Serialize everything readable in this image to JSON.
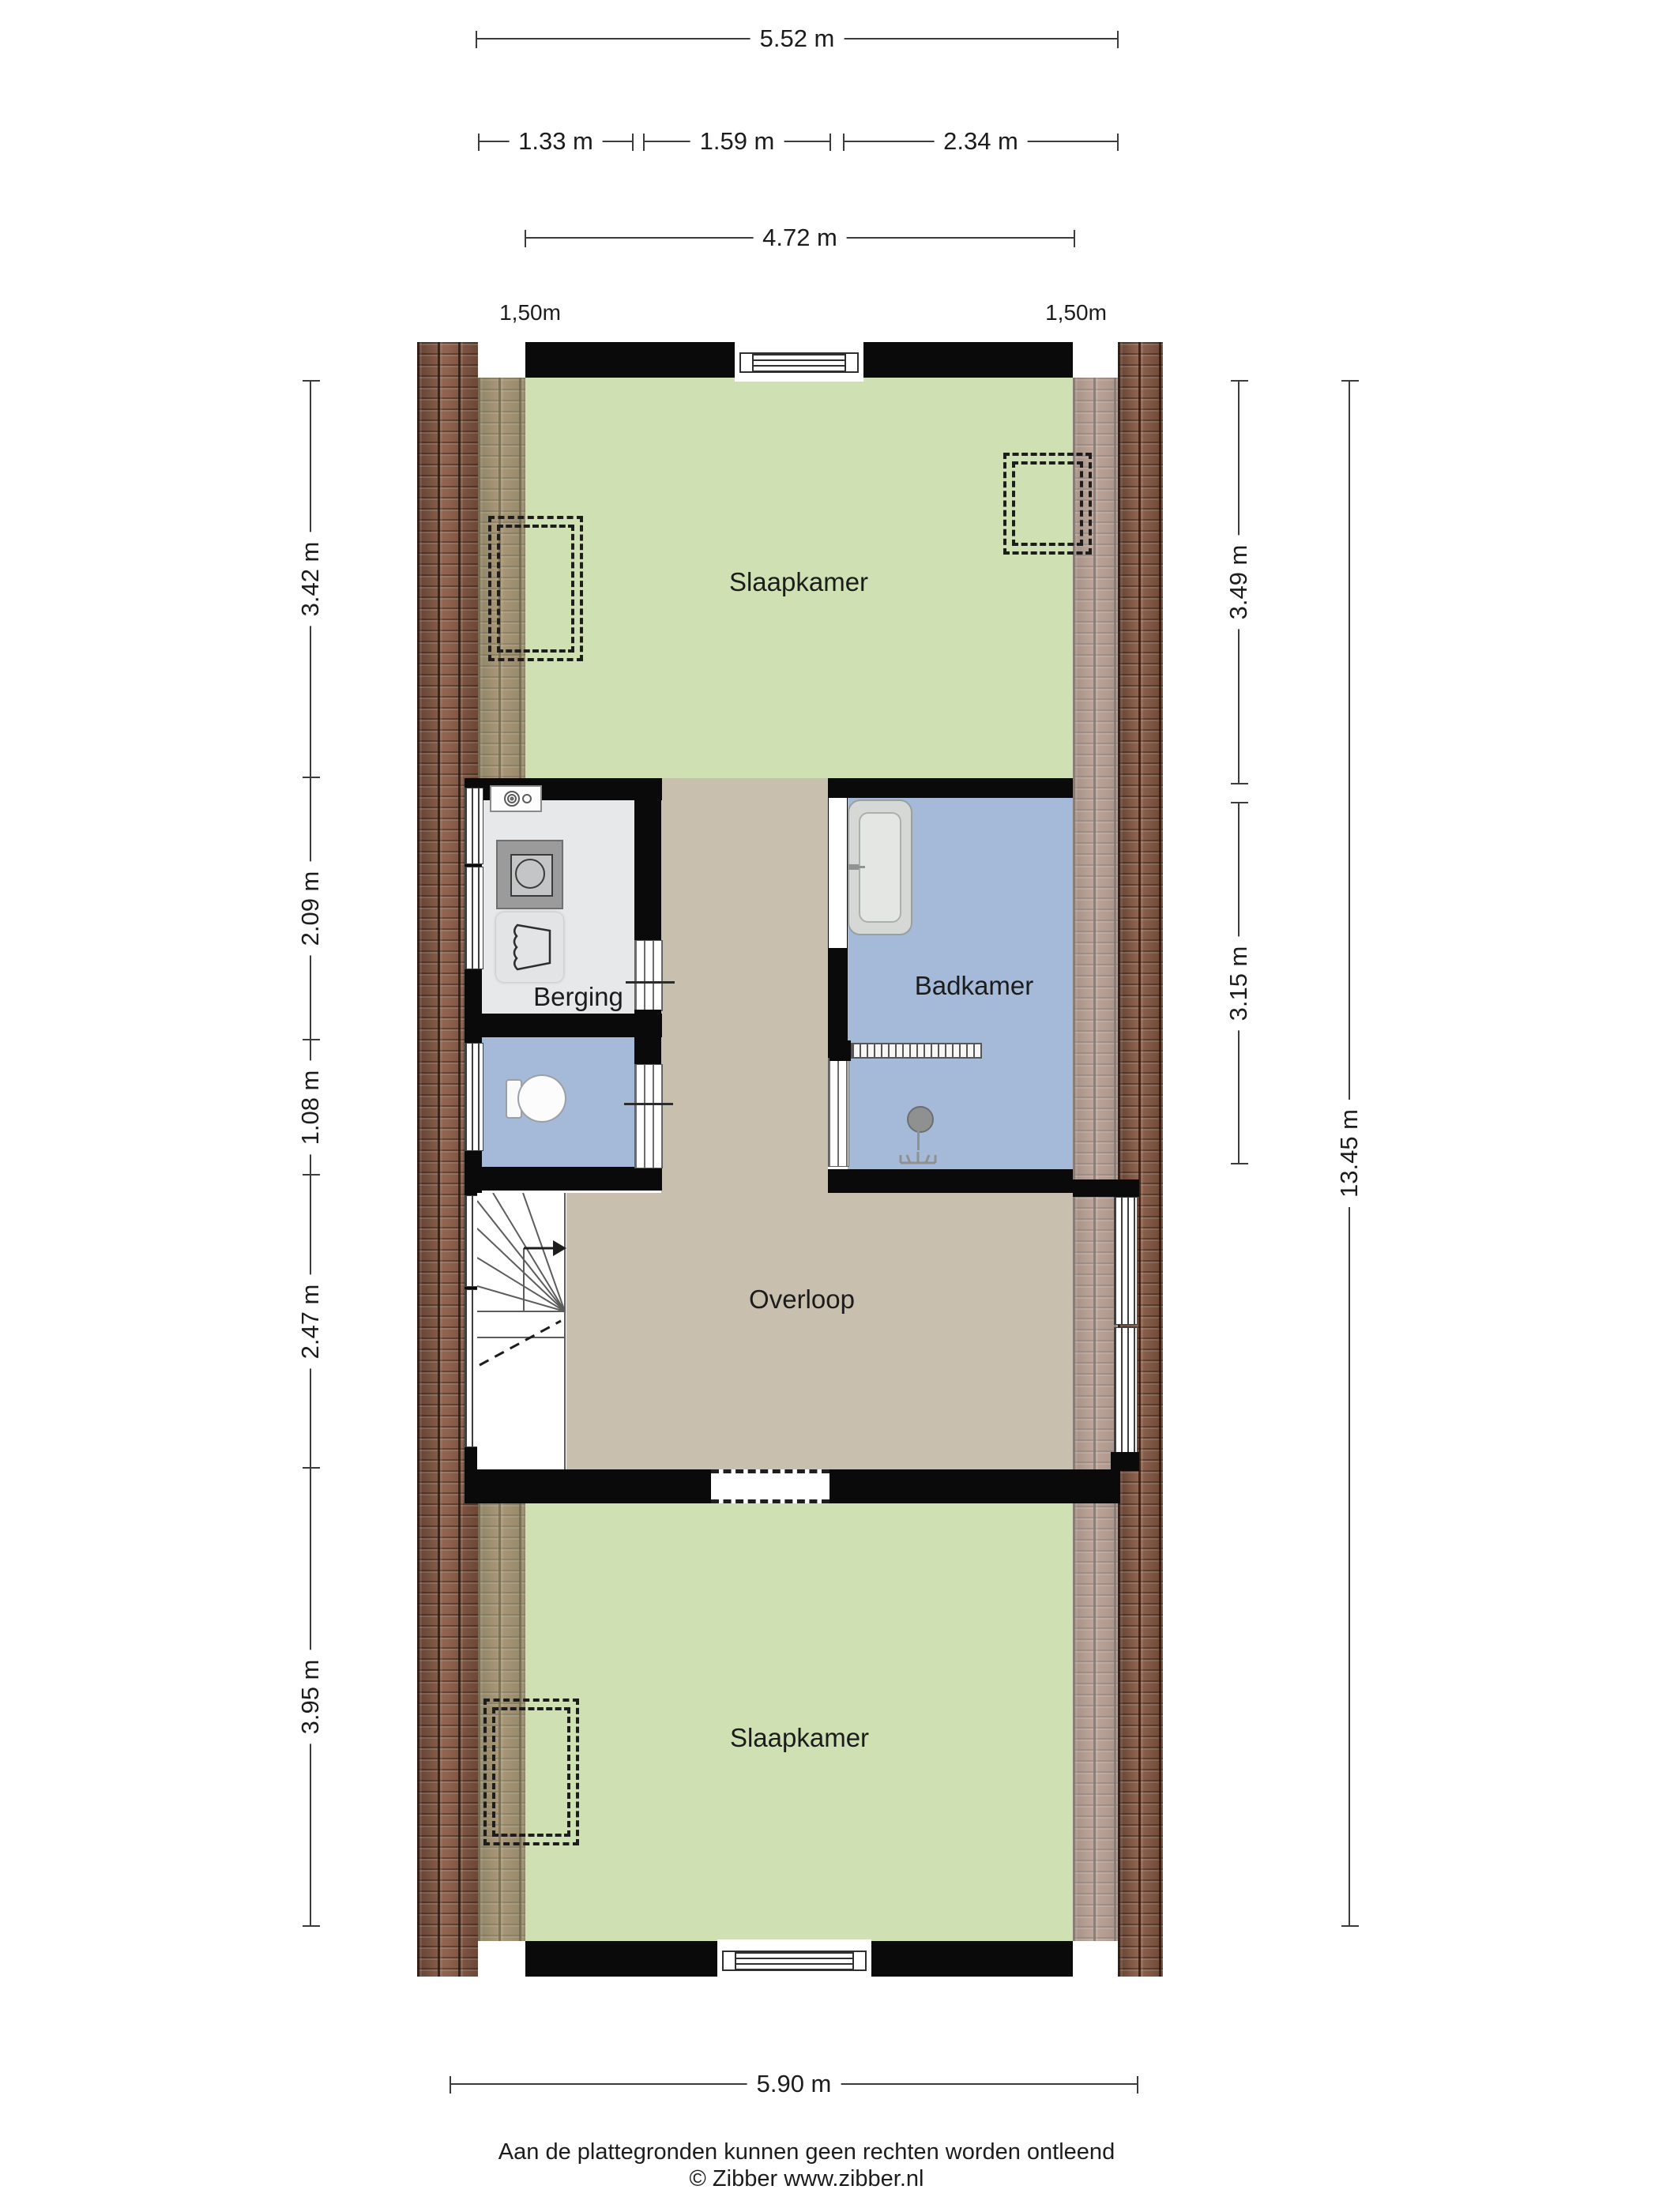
{
  "document": {
    "kind": "floor-plan",
    "floor": "verdieping"
  },
  "colors": {
    "floor_bedroom": "#cfe0b2",
    "floor_landing": "#c8bfae",
    "floor_bathroom": "#a4bad8",
    "floor_storage": "#e7e8ea",
    "roof_brick": "#8a5b45",
    "wall": "#0a0a0a"
  },
  "dimensions": {
    "top_total": "5.52 m",
    "top_segments": [
      "1.33 m",
      "1.59 m",
      "2.34 m"
    ],
    "top_inner": "4.72 m",
    "left": [
      "3.42 m",
      "2.09 m",
      "1.08 m",
      "2.47 m",
      "3.95 m"
    ],
    "right": [
      "3.49 m",
      "3.15 m"
    ],
    "right_total": "13.45 m",
    "bottom": "5.90 m"
  },
  "knee_wall": {
    "left": "1,50m",
    "right": "1,50m"
  },
  "rooms": {
    "bedroom_top": "Slaapkamer",
    "storage": "Berging",
    "bathroom": "Badkamer",
    "landing": "Overloop",
    "bedroom_bottom": "Slaapkamer"
  },
  "footer": {
    "disclaimer": "Aan de plattegronden kunnen geen rechten worden ontleend",
    "copyright": "© Zibber www.zibber.nl"
  }
}
